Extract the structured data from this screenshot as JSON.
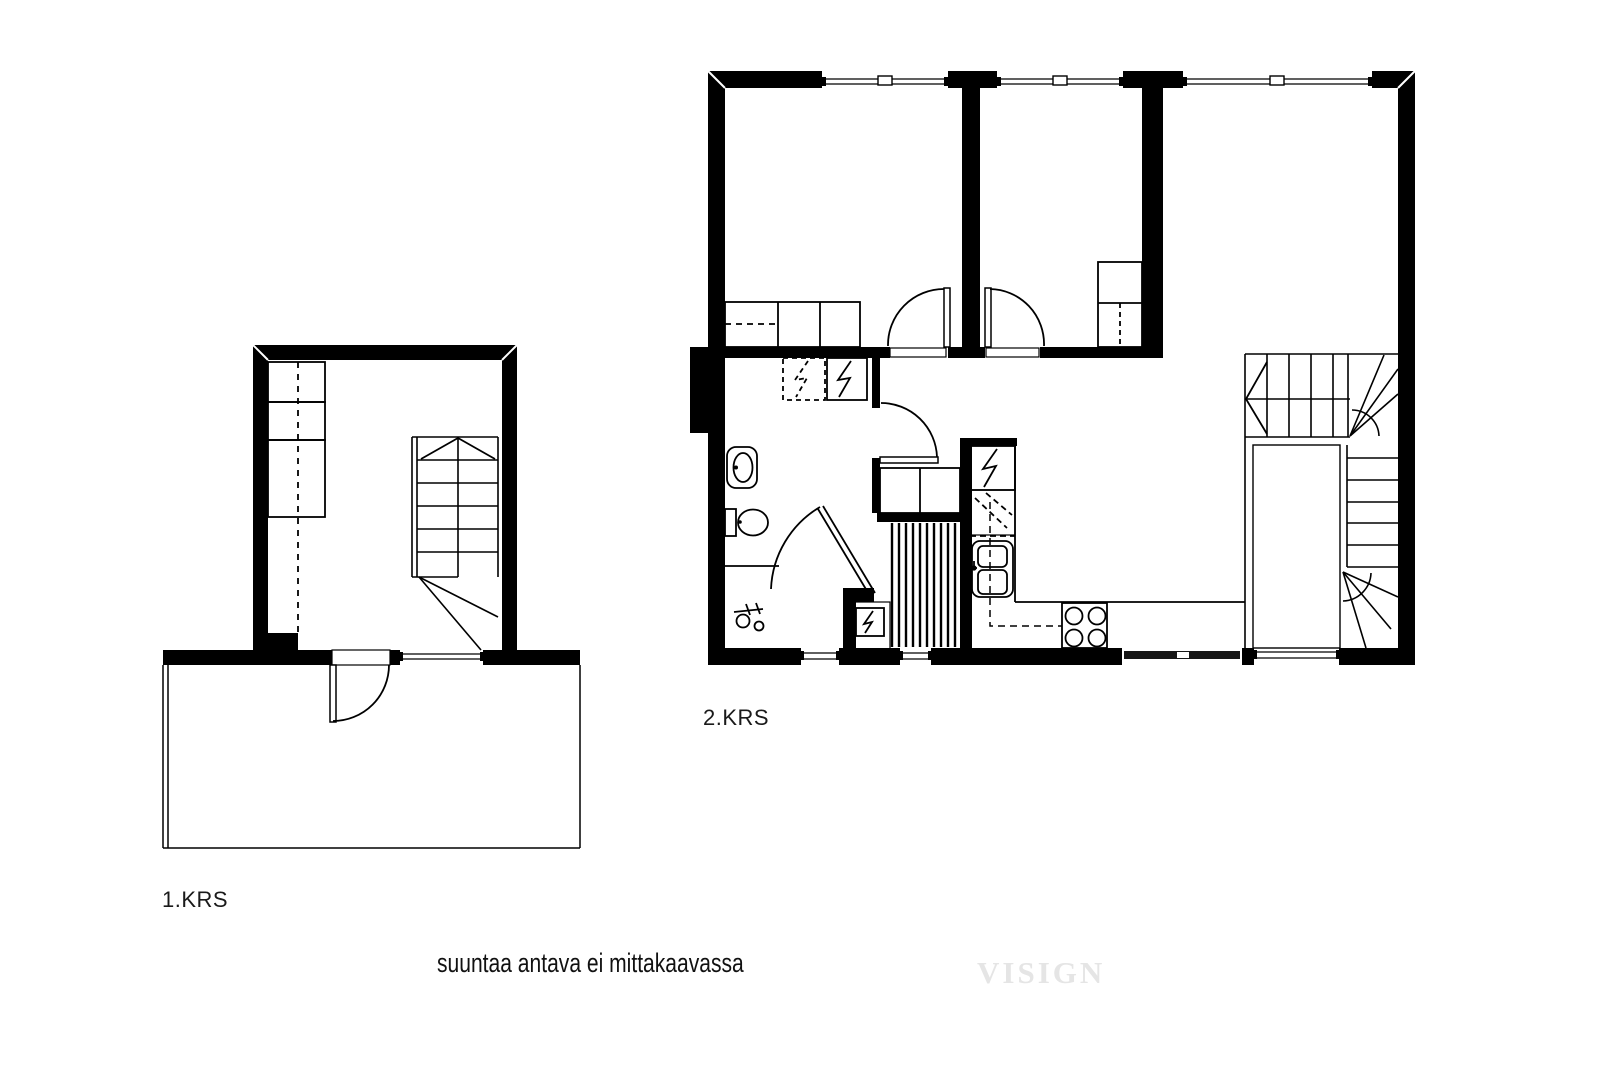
{
  "floors": [
    {
      "label": "1.KRS",
      "features": [
        "staircase",
        "wardrobes",
        "entrance-door",
        "window",
        "terrace"
      ]
    },
    {
      "label": "2.KRS",
      "features": [
        "bedroom-1",
        "bedroom-2",
        "living-room",
        "hallway",
        "bathroom",
        "sauna",
        "kitchen",
        "staircase",
        "wardrobes",
        "toilet",
        "washbasin",
        "shower-mixer",
        "sauna-heater",
        "fridge",
        "kitchen-sink",
        "stove",
        "washing-machine",
        "appliance-reservation",
        "windows"
      ]
    }
  ],
  "note": "suuntaa antava ei mittakaavassa",
  "watermark": "VISIGN",
  "colors": {
    "ink": "#000000",
    "background": "#ffffff",
    "label_text": "#1a1a1a",
    "watermark": "#e5e5e5"
  }
}
